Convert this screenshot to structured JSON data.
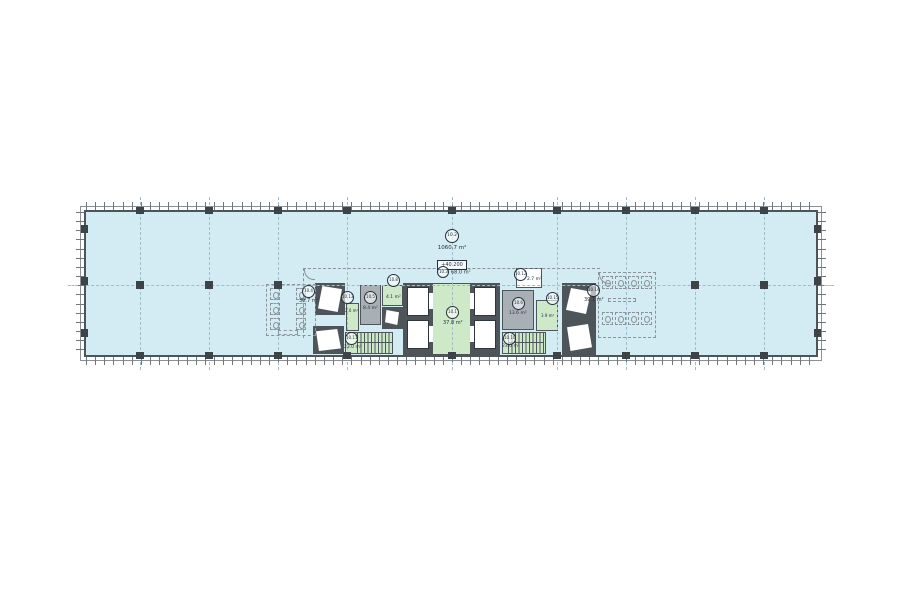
{
  "floor": {
    "id": "10.2",
    "area": "1060.7 m²",
    "level": "+40.200"
  },
  "rooms": [
    {
      "id": "10.1",
      "name": "elevator-lobby",
      "area": "37.8 m²"
    },
    {
      "id": "10.3",
      "name": "corridor",
      "area": "68.0 m²"
    },
    {
      "id": "10.4",
      "name": "wc-left",
      "area": "30.7 m²"
    },
    {
      "id": "10.5",
      "name": "service-room-left",
      "area": "8.4 m²"
    },
    {
      "id": "10.13",
      "name": "shaft-lobby-left",
      "area": "2.0 m²"
    },
    {
      "id": "10.8",
      "name": "small-room-left",
      "area": "4.1 m²"
    },
    {
      "id": "10.11",
      "name": "stair-left",
      "area": "23.0 m²"
    },
    {
      "id": "10.12",
      "name": "small-room-right-top",
      "area": "2.7 m²"
    },
    {
      "id": "10.6",
      "name": "service-room-right",
      "area": "13.6 m²"
    },
    {
      "id": "10.15",
      "name": "shaft-lobby-right",
      "area": "3.9 m²"
    },
    {
      "id": "10.10",
      "name": "stair-right",
      "area": "23.0 m²"
    },
    {
      "id": "10.14",
      "name": "wc-right",
      "area": "39.1 m²"
    }
  ],
  "colors": {
    "floor_fill": "#d3ebf2",
    "room_green": "#cde9c8",
    "wall": "#4d545a",
    "service_gray": "#a9b0b5",
    "grid_line": "#9dbdc8"
  }
}
